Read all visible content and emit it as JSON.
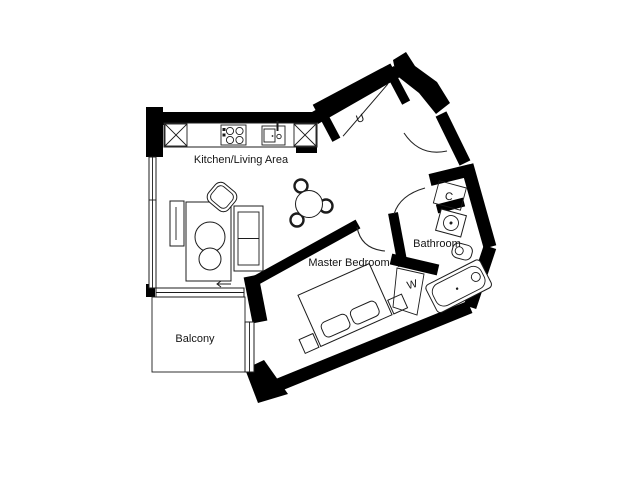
{
  "floorplan": {
    "labels": {
      "kitchen_living": "Kitchen/Living Area",
      "master_bedroom": "Master Bedroom",
      "bathroom": "Bathroom",
      "balcony": "Balcony",
      "utility": "U",
      "cupboard": "C",
      "wardrobe": "W"
    },
    "colors": {
      "wall": "#000000",
      "background": "#ffffff",
      "line": "#1c1c1c"
    }
  }
}
